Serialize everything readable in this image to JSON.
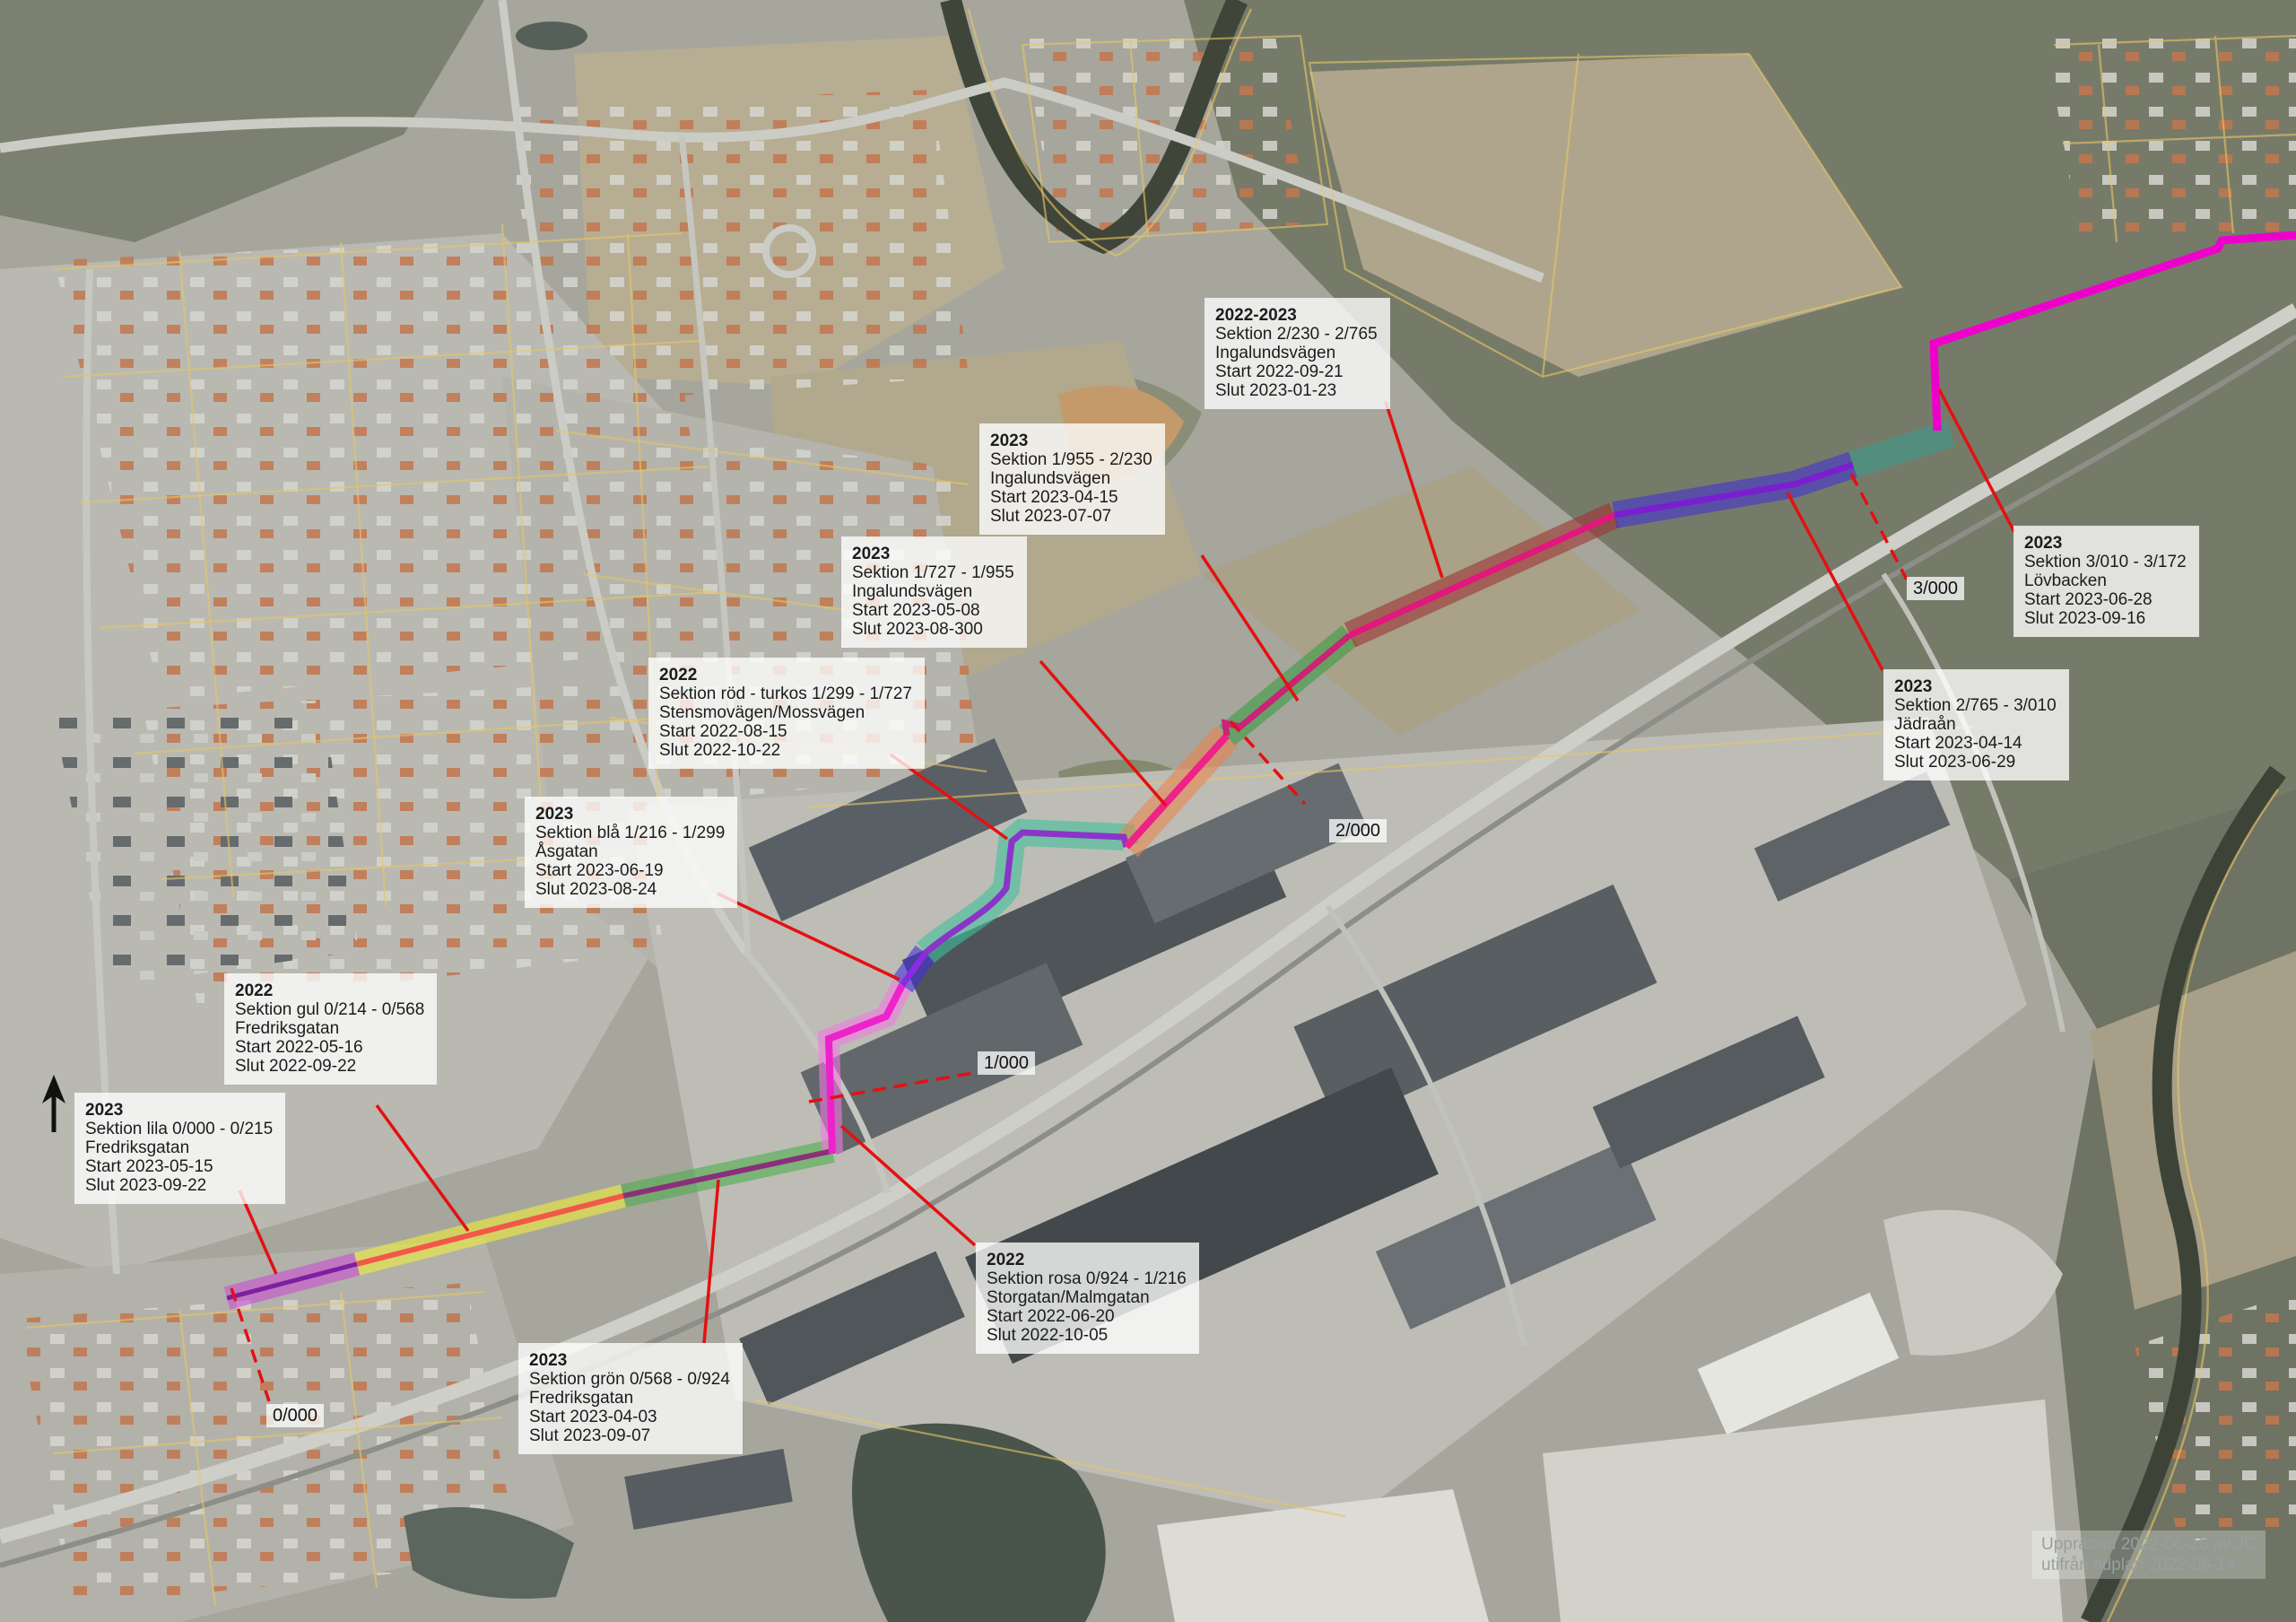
{
  "callouts": [
    {
      "year": "2023",
      "section": "Sektion lila 0/000 - 0/215",
      "street": "Fredriksgatan",
      "start": "Start 2023-05-15",
      "end": "Slut 2023-09-22"
    },
    {
      "year": "2022",
      "section": "Sektion gul 0/214 - 0/568",
      "street": "Fredriksgatan",
      "start": "Start 2022-05-16",
      "end": "Slut 2022-09-22"
    },
    {
      "year": "2023",
      "section": "Sektion grön 0/568 - 0/924",
      "street": "Fredriksgatan",
      "start": "Start 2023-04-03",
      "end": "Slut 2023-09-07"
    },
    {
      "year": "2022",
      "section": "Sektion rosa 0/924 - 1/216",
      "street": "Storgatan/Malmgatan",
      "start": "Start 2022-06-20",
      "end": "Slut 2022-10-05"
    },
    {
      "year": "2023",
      "section": "Sektion blå 1/216 - 1/299",
      "street": "Åsgatan",
      "start": "Start 2023-06-19",
      "end": "Slut 2023-08-24"
    },
    {
      "year": "2022",
      "section": "Sektion röd - turkos 1/299 - 1/727",
      "street": "Stensmovägen/Mossvägen",
      "start": "Start 2022-08-15",
      "end": "Slut 2022-10-22"
    },
    {
      "year": "2023",
      "section": "Sektion 1/727 - 1/955",
      "street": "Ingalundsvägen",
      "start": "Start 2023-05-08",
      "end": "Slut 2023-08-300"
    },
    {
      "year": "2023",
      "section": "Sektion 1/955 - 2/230",
      "street": "Ingalundsvägen",
      "start": "Start 2023-04-15",
      "end": "Slut 2023-07-07"
    },
    {
      "year": "2022-2023",
      "section": "Sektion 2/230 - 2/765",
      "street": "Ingalundsvägen",
      "start": "Start 2022-09-21",
      "end": "Slut 2023-01-23"
    },
    {
      "year": "2023",
      "section": "Sektion 2/765 - 3/010",
      "street": "Jädraån",
      "start": "Start 2023-04-14",
      "end": "Slut 2023-06-29"
    },
    {
      "year": "2023",
      "section": "Sektion 3/010 - 3/172",
      "street": "Lövbacken",
      "start": "Start 2023-06-28",
      "end": "Slut 2023-09-16"
    }
  ],
  "markers": {
    "m0": "0/000",
    "m1": "1/000",
    "m2": "2/000",
    "m3": "3/000"
  },
  "attribution": {
    "line1": "Upprättad 2022-06-16 av JC",
    "line2": "utifrån tidplan 2022-06-14"
  },
  "colors": {
    "lila_band": "#c94fd0",
    "lila_line": "#7c1fa0",
    "gul_band": "#f0ee3c",
    "gul_line": "#f25848",
    "gron_band": "#4cae4c",
    "gron_line": "#8c2f7a",
    "rosa_band": "#f07ae0",
    "rosa_line": "#ee22cc",
    "bla_band": "#4430d8",
    "bla_line": "#8a2be2",
    "turkos_band": "#3fbf9b",
    "turkos_line": "#8a35c8",
    "orange_band": "#e8854e",
    "orange_line": "#ee2288",
    "gron2_band": "#3a9e42",
    "gron2_line": "#cc2277",
    "crimson_band": "#9e3434",
    "crimson_line": "#e0187c",
    "indigo_band": "#4534cf",
    "indigo_line": "#7a1fd0",
    "teal_band": "#3a9a8a",
    "magenta_line": "#ee00cc",
    "annotation_red": "#e51010",
    "cadastral_yellow": "#e5c565"
  }
}
